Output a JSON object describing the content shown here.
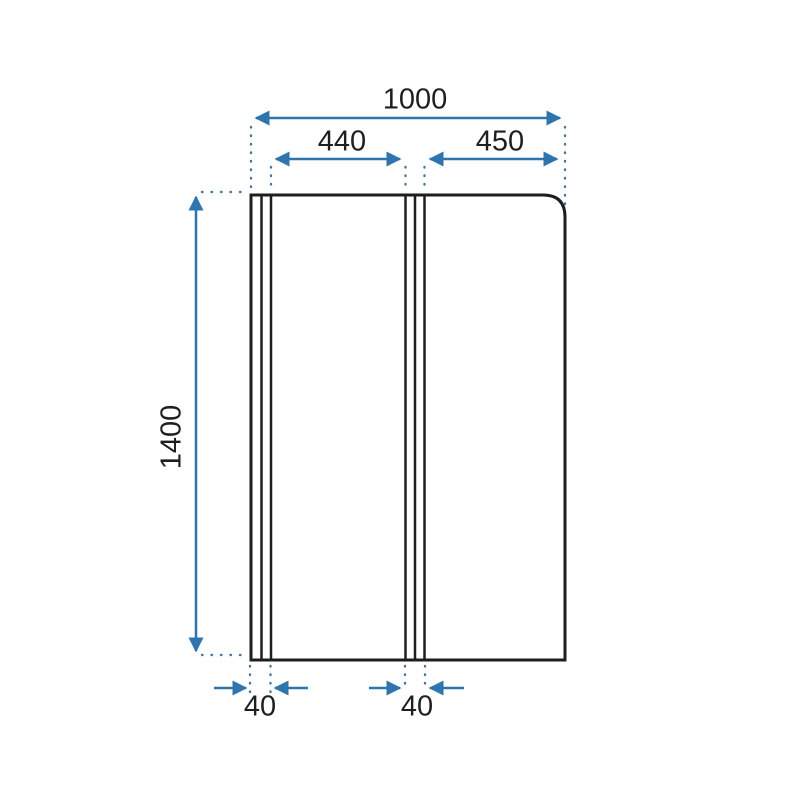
{
  "meta": {
    "drawing_type": "technical-dimension-drawing",
    "subject": "two-panel bath shower screen, front view"
  },
  "labels": {
    "total_width": "1000",
    "left_panel_width": "440",
    "right_panel_width": "450",
    "height": "1400",
    "left_profile_width": "40",
    "middle_profile_width": "40"
  },
  "colors": {
    "dimension_blue": "#2f74ad",
    "dotted_guide_blue": "#47769f",
    "outline_black": "#1e1e1e",
    "background": "#ffffff"
  }
}
